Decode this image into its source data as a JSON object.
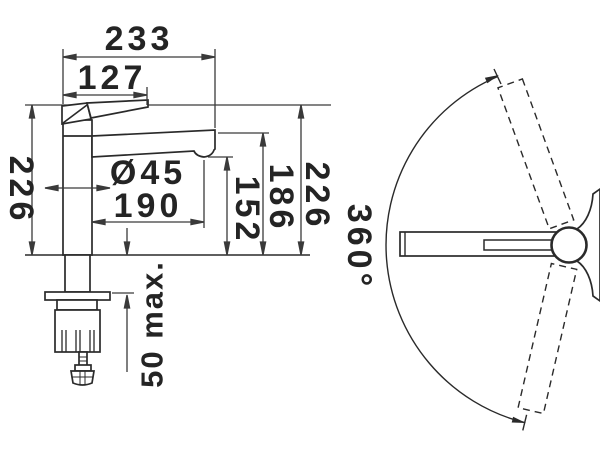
{
  "dims": {
    "overall_width": "233",
    "lever_reach": "127",
    "height_to_top_left": "226",
    "body_diameter": "Ø45",
    "spout_reach": "190",
    "outlet_height": "152",
    "spout_top_height": "186",
    "overall_height_right": "226",
    "max_counter_thickness": "50 max.",
    "swivel_angle": "360°"
  },
  "style": {
    "background": "#ffffff",
    "outline_color": "#2a2a2a",
    "dimension_color": "#3a3a3a",
    "text_color": "#242424"
  }
}
